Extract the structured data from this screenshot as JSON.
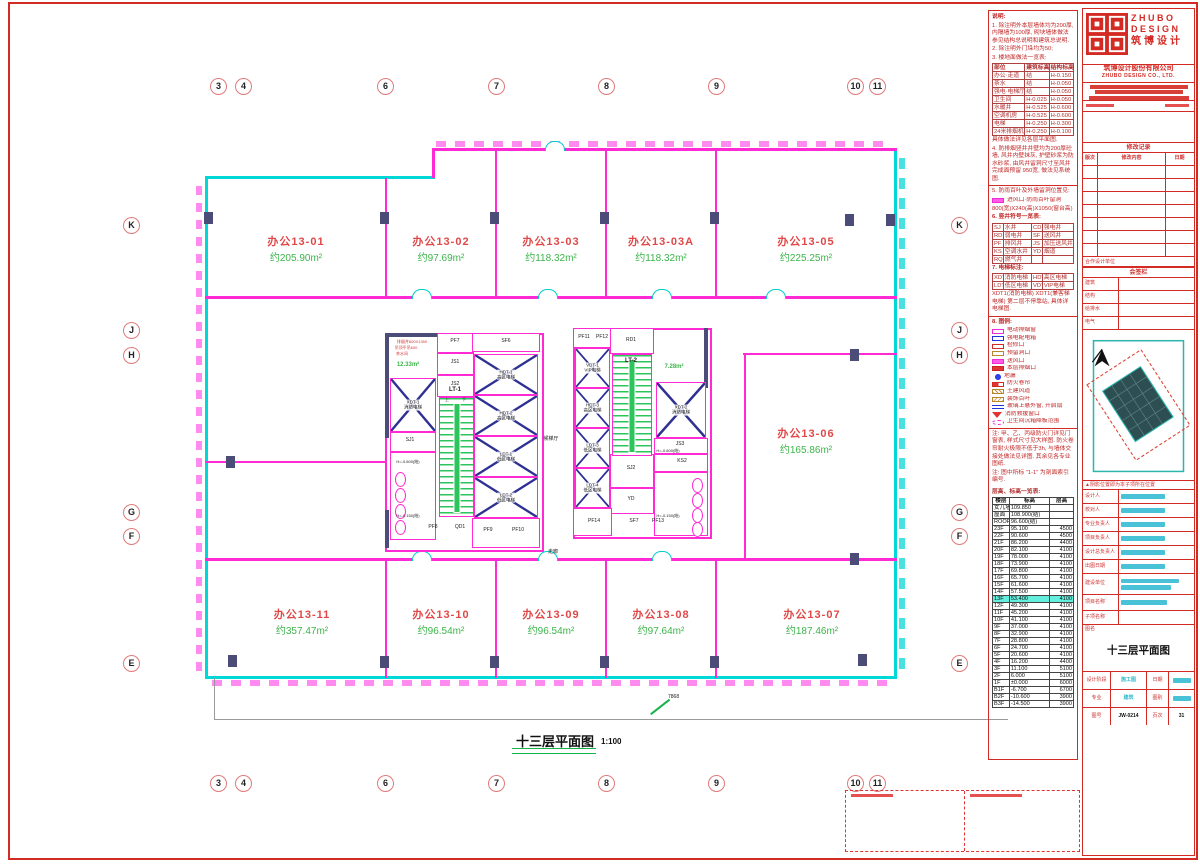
{
  "plan": {
    "title": "十三层平面图",
    "scale": "1:100",
    "grid_cols": [
      "3",
      "4",
      "6",
      "7",
      "8",
      "9",
      "10",
      "11"
    ],
    "grid_rows": [
      "K",
      "J",
      "H",
      "G",
      "F",
      "E"
    ],
    "rooms": [
      {
        "id": "办公13-01",
        "area": "约205.90m²"
      },
      {
        "id": "办公13-02",
        "area": "约97.69m²"
      },
      {
        "id": "办公13-03",
        "area": "约118.32m²"
      },
      {
        "id": "办公13-03A",
        "area": "约118.32m²"
      },
      {
        "id": "办公13-05",
        "area": "约225.25m²"
      },
      {
        "id": "办公13-06",
        "area": "约165.86m²"
      },
      {
        "id": "办公13-07",
        "area": "约187.46m²"
      },
      {
        "id": "办公13-08",
        "area": "约97.64m²"
      },
      {
        "id": "办公13-09",
        "area": "约96.54m²"
      },
      {
        "id": "办公13-10",
        "area": "约96.54m²"
      },
      {
        "id": "办公13-11",
        "area": "约357.47m²"
      }
    ],
    "core": [
      "PF7",
      "JS1",
      "JS2",
      "SF6",
      "HDT-1",
      "高区电梯",
      "HDT-2",
      "高区电梯",
      "LDT-1",
      "低区电梯",
      "LDT-2",
      "低区电梯",
      "LT-1",
      "SJ1",
      "XDT-1",
      "消防电梯",
      "QD1",
      "PF8",
      "PF9",
      "PF10",
      "12.33m²",
      "茶水间",
      "PF11",
      "PF12",
      "RD1",
      "LT-2",
      "VDT-1",
      "VIP电梯",
      "HDT-3",
      "高区电梯",
      "LDT-3",
      "低区电梯",
      "LDT-4",
      "低区电梯",
      "XDT-2",
      "消防电梯",
      "7.28m²",
      "JS3",
      "KS2",
      "SJ2",
      "YD",
      "SF7",
      "PF13",
      "PF14",
      "候梯厅",
      "H=-0.600(结)",
      "H=-0.150(结)",
      "H=-0.600(结)",
      "H=-0.150(结)",
      "走廊",
      "上",
      "下"
    ],
    "ann": {
      "vent": "排烟井600X1350",
      "ceil": "吊顶平吊600",
      "dim": "7868"
    }
  },
  "notes": {
    "t": "说明:",
    "n1": "1. 除注明外本层墙体均为200厚, 内隔墙为100厚, 砌块墙体做法参见结构总说明和建筑总说明.",
    "n2": "2. 除注明外门垛均为50;",
    "n3": "3. 楼地面做法一览表:",
    "ft_head": [
      "部位",
      "建筑标高",
      "结构标高"
    ],
    "ft": [
      [
        "办公·走道",
        "结",
        "H-0.150"
      ],
      [
        "茶水",
        "结",
        "H-0.050"
      ],
      [
        "强电·电梯厅",
        "结",
        "H-0.050"
      ],
      [
        "卫生间",
        "H-0.025",
        "H-0.050"
      ],
      [
        "水暖井",
        "H-0.525",
        "H-0.600"
      ],
      [
        "空调机房",
        "H-0.525",
        "H-0.600"
      ],
      [
        "电梯",
        "H-0.250",
        "H-0.300"
      ],
      [
        "24米排烟机房",
        "H-0.250",
        "H-0.100"
      ]
    ],
    "ft_note": "具体做法详见各层平面图.",
    "n4": "4. 防排烟竖井井壁均为200厚砼墙, 风井内壁抹灰, 护壁砂浆为防水砂浆, 由风井留洞尺寸至风井完成面预留 950宽, 做法见系统图.",
    "n5": "5. 防雨百叶及外墙留洞位置见:",
    "n5a": "进风口·防雨百叶留洞",
    "n5b": "800(宽)X240(高)X1050(窗台高)",
    "n6": "6. 竖井符号一览表:",
    "shaft": [
      [
        "SJ",
        "水井",
        "CD",
        "强电井"
      ],
      [
        "RD",
        "弱电井",
        "SF",
        "送风井"
      ],
      [
        "PF",
        "排风井",
        "JS",
        "加压送风井"
      ],
      [
        "KS",
        "空调水井",
        "YD",
        "烟道"
      ],
      [
        "RQ",
        "燃气井",
        "",
        ""
      ]
    ],
    "n7": "7. 电梯标注:",
    "elev": [
      [
        "XDT",
        "消防电梯",
        "HDT",
        "高区电梯"
      ],
      [
        "LDT",
        "低区电梯",
        "VDT",
        "VIP电梯"
      ]
    ],
    "n7a": "XDT1(消防电梯) XDT1(兼客梯电梯) 第二层不停靠站, 具体详电梯图.",
    "n8": "8. 图例:",
    "legend": [
      {
        "sw": "mbox",
        "label": "电动排烟窗"
      },
      {
        "sw": "bbox",
        "label": "强电配电箱"
      },
      {
        "sw": "rbox",
        "label": "检修口"
      },
      {
        "sw": "tbox",
        "label": "预留洞口"
      },
      {
        "sw": "mfill",
        "label": "送风口"
      },
      {
        "sw": "rsq",
        "label": "本层排烟口"
      },
      {
        "sw": "bdot",
        "label": "地漏"
      },
      {
        "sw": "rwedge",
        "label": "防火卷帘"
      },
      {
        "sw": "thatch",
        "label": "土建风道"
      },
      {
        "sw": "thatch2",
        "label": "装饰百叶"
      },
      {
        "sw": "bline",
        "label": "玻璃上悬外窗, 开启扇"
      },
      {
        "sw": "rtri",
        "label": "消防救援窗口"
      },
      {
        "sw": "moval",
        "label": "卫生间沉箱降板范围"
      }
    ],
    "z1": "注: 甲、乙、丙级防火门详见门窗表, 样式尺寸见大样图. 防火卷帘耐火极限不低于3h, 与墙体交接处做法见详图. 其余见各专业图纸.",
    "z2": "注: 图中所标 \"1-1\" 为剖面索引编号."
  },
  "floor": {
    "title": "层高、标高一览表:",
    "head": [
      "楼层",
      "标高",
      "层高"
    ],
    "rows": [
      {
        "f": "女儿墙",
        "e": "109.850",
        "h": ""
      },
      {
        "f": "屋面",
        "e": "108.900(结)",
        "h": ""
      },
      {
        "f": "ROOF",
        "e": "96.600(结)",
        "h": ""
      },
      {
        "f": "23F",
        "e": "95.100",
        "h": "4500"
      },
      {
        "f": "22F",
        "e": "90.600",
        "h": "4500"
      },
      {
        "f": "21F",
        "e": "86.200",
        "h": "4400"
      },
      {
        "f": "20F",
        "e": "82.100",
        "h": "4100"
      },
      {
        "f": "19F",
        "e": "78.000",
        "h": "4100"
      },
      {
        "f": "18F",
        "e": "73.900",
        "h": "4100"
      },
      {
        "f": "17F",
        "e": "69.800",
        "h": "4100"
      },
      {
        "f": "16F",
        "e": "65.700",
        "h": "4100"
      },
      {
        "f": "15F",
        "e": "61.600",
        "h": "4100"
      },
      {
        "f": "14F",
        "e": "57.500",
        "h": "4100"
      },
      {
        "f": "13F",
        "e": "53.400",
        "h": "4100",
        "hl": true
      },
      {
        "f": "12F",
        "e": "49.300",
        "h": "4100"
      },
      {
        "f": "11F",
        "e": "45.200",
        "h": "4100"
      },
      {
        "f": "10F",
        "e": "41.100",
        "h": "4100"
      },
      {
        "f": "9F",
        "e": "37.000",
        "h": "4100"
      },
      {
        "f": "8F",
        "e": "32.900",
        "h": "4100"
      },
      {
        "f": "7F",
        "e": "28.800",
        "h": "4100"
      },
      {
        "f": "6F",
        "e": "24.700",
        "h": "4100"
      },
      {
        "f": "5F",
        "e": "20.600",
        "h": "4100"
      },
      {
        "f": "4F",
        "e": "16.200",
        "h": "4400"
      },
      {
        "f": "3F",
        "e": "11.100",
        "h": "5100"
      },
      {
        "f": "2F",
        "e": "6.000",
        "h": "5100"
      },
      {
        "f": "1F",
        "e": "±0.000",
        "h": "6000"
      },
      {
        "f": "B1F",
        "e": "-6.700",
        "h": "6700"
      },
      {
        "f": "B2F",
        "e": "-10.600",
        "h": "3900"
      },
      {
        "f": "B3F",
        "e": "-14.500",
        "h": "3900"
      }
    ]
  },
  "tb": {
    "logo_en1": "ZHUBO",
    "logo_en2": "DESIGN",
    "logo_cn": "筑博设计",
    "company_cn": "筑博设计股份有限公司",
    "company_en": "ZHUBO DESIGN CO., LTD.",
    "rev_title": "修改记录",
    "rev_head": [
      "版次",
      "修改内容",
      "日期"
    ],
    "coop": "合作设计单位",
    "sign_title": "会签栏",
    "sign_rows": [
      "建筑",
      "结构",
      "给排水",
      "电气"
    ],
    "kp_note": "▲阴影位置即为本子项所在位置",
    "pers": [
      "设计人",
      "校对人",
      "专业负责人",
      "项目负责人",
      "设计总负责人",
      "出图日期"
    ],
    "owner_label": "建设单位",
    "project_label": "项目名称",
    "sub_label": "子项名称",
    "dwg_label": "图名",
    "dwg_name": "十三层平面图",
    "stage_label": "设计阶段",
    "stage": "施工图",
    "date_label": "日期",
    "major_label": "专业",
    "major": "建筑",
    "type_label": "图别",
    "no_label": "图号",
    "no": "JW-0214",
    "page_label": "页次",
    "page": "31"
  }
}
